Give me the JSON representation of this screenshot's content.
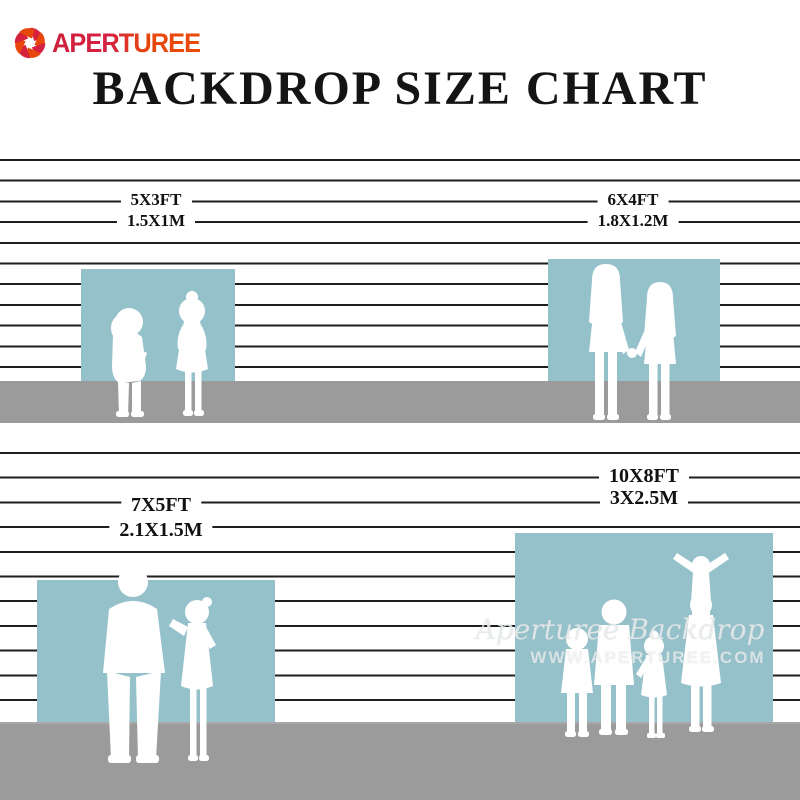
{
  "brand": {
    "name": "APERTUREE",
    "icon": "aperture-icon"
  },
  "title": "BACKDROP SIZE CHART",
  "sections": [
    {
      "id": "5x3",
      "size_ft": "5X3FT",
      "size_m": "1.5X1M",
      "figures": "two toddlers"
    },
    {
      "id": "6x4",
      "size_ft": "6X4FT",
      "size_m": "1.8X1.2M",
      "figures": "two girls holding hands"
    },
    {
      "id": "7x5",
      "size_ft": "7X5FT",
      "size_m": "2.1X1.5M",
      "figures": "man and girl"
    },
    {
      "id": "10x8",
      "size_ft": "10X8FT",
      "size_m": "3X2.5M",
      "figures": "family of five with cheerleader"
    }
  ],
  "watermark": {
    "script": "Aperturee Backdrop",
    "url": "WWW.APERTUREE.COM"
  },
  "colors": {
    "backdrop_blue": "#95c1cb",
    "floor_gray": "#9b9b9b",
    "wall_line": "#1e1e1e",
    "brand_red": "#d52243",
    "brand_orange": "#e8470c",
    "title_black": "#141414"
  }
}
